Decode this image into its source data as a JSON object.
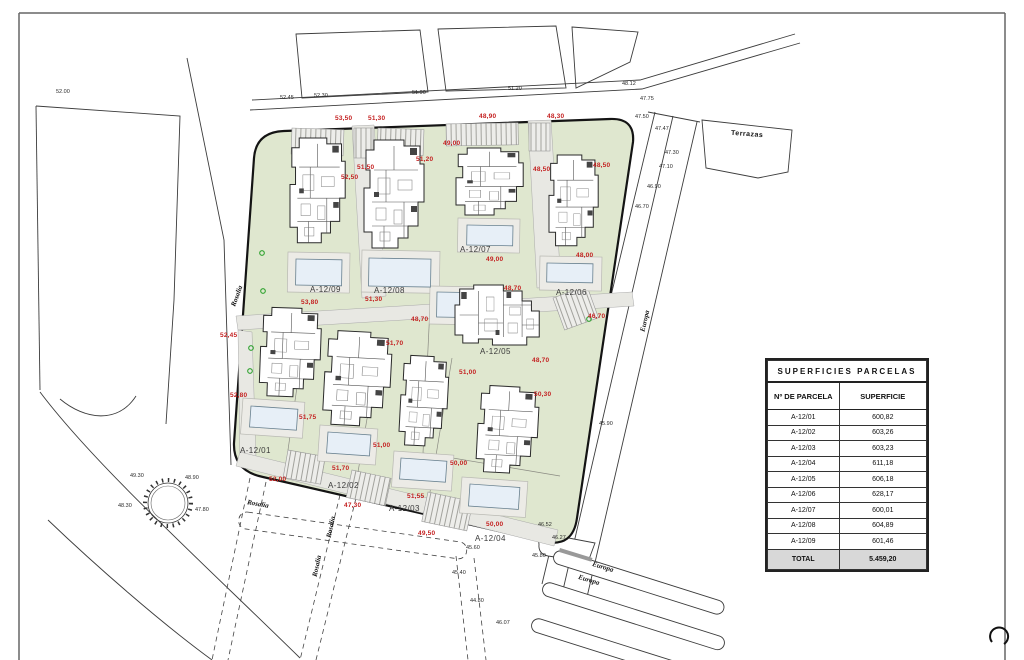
{
  "colors": {
    "red_dim": "#c42222",
    "green_area": "#dfe7cf",
    "grey_area": "#e8e8e3",
    "pool": "#e7eff7",
    "marker_green": "#2da22d"
  },
  "table": {
    "title": "SUPERFICIES PARCELAS",
    "col_parcel": "Nº DE PARCELA",
    "col_surface": "SUPERFICIE",
    "rows": [
      {
        "parcel": "A-12/01",
        "surface": "600,82"
      },
      {
        "parcel": "A-12/02",
        "surface": "603,26"
      },
      {
        "parcel": "A-12/03",
        "surface": "603,23"
      },
      {
        "parcel": "A-12/04",
        "surface": "611,18"
      },
      {
        "parcel": "A-12/05",
        "surface": "606,18"
      },
      {
        "parcel": "A-12/06",
        "surface": "628,17"
      },
      {
        "parcel": "A-12/07",
        "surface": "600,01"
      },
      {
        "parcel": "A-12/08",
        "surface": "604,89"
      },
      {
        "parcel": "A-12/09",
        "surface": "601,46"
      }
    ],
    "total_label": "TOTAL",
    "total_value": "5.459,20"
  },
  "parcel_labels": [
    "A-12/01",
    "A-12/02",
    "A-12/03",
    "A-12/04",
    "A-12/05",
    "A-12/06",
    "A-12/07",
    "A-12/08",
    "A-12/09"
  ],
  "streets": {
    "left": "Rosalia",
    "top_right": "Terrazas",
    "right": "Europa",
    "bottom_a": "Europa",
    "bottom_b": "Europa",
    "path_a": "Rosalia",
    "path_b": "Rosalia",
    "path_c": "Rosalia"
  },
  "dims": [
    "53,50",
    "51,30",
    "48,90",
    "48,30",
    "49,00",
    "51,20",
    "51,50",
    "52,50",
    "48,50",
    "48,50",
    "53,80",
    "51,30",
    "49,00",
    "48,00",
    "48,70",
    "46,70",
    "52,45",
    "48,70",
    "51,70",
    "48,70",
    "52,80",
    "51,75",
    "51,00",
    "50,30",
    "51,00",
    "51,70",
    "52,00",
    "51,55",
    "47,30",
    "50,00",
    "50,00",
    "49,50"
  ],
  "elevations": [
    "52.45",
    "52.30",
    "51.90",
    "51.20",
    "48.12",
    "47.75",
    "47.50",
    "47.47",
    "47.30",
    "47.10",
    "46.90",
    "46.70",
    "49.30",
    "48.90",
    "48.30",
    "47.80",
    "46.52",
    "46.27",
    "45.80",
    "45.60",
    "45.40",
    "44.80",
    "45.90",
    "46.07",
    "52.00"
  ]
}
